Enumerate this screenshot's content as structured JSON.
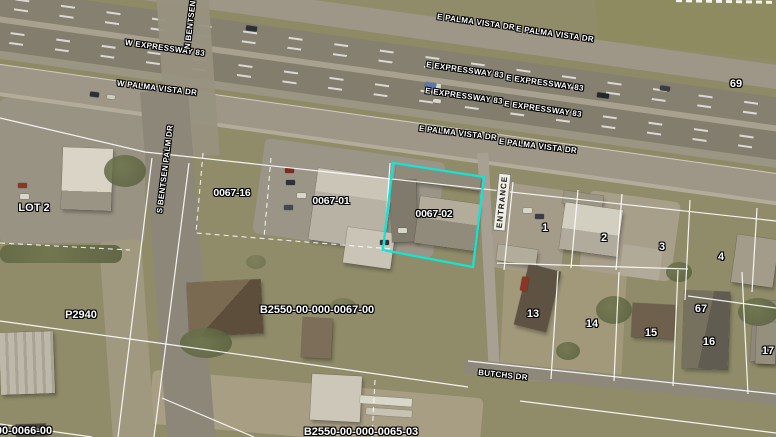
{
  "app": {
    "type": "aerial-parcel-map-viewer"
  },
  "highway_labels": {
    "w_expressway": "W EXPRESSWAY 83",
    "e_expressway": "E EXPRESSWAY 83",
    "w_palma_vista": "W PALMA VISTA DR",
    "e_palma_vista": "E PALMA VISTA DR"
  },
  "street_labels": {
    "n_bentsen_clipped": "N BENTSEN PA",
    "s_bentsen": "S BENTSEN PALM DR",
    "butchs": "BUTCHS DR",
    "entrance": "ENTRANCE"
  },
  "parcel_labels": {
    "lot2": "LOT 2",
    "p2940": "P2940",
    "parcel_0067_16": "0067-16",
    "parcel_0067_01": "0067-01",
    "parcel_0067_02": "0067-02",
    "account_0067": "B2550-00-000-0067-00",
    "account_0065": "B2550-00-000-0065-03",
    "account_0066_clipped": "00-0066-00"
  },
  "lot_numbers": [
    "1",
    "2",
    "3",
    "4",
    "13",
    "14",
    "15",
    "16",
    "17",
    "67",
    "69"
  ],
  "selection": {
    "selected_parcel": "0067-02",
    "highlight_color": "#17E2D3"
  },
  "label_style": {
    "text_color": "#FFFFFF",
    "outline_color": "#000000"
  }
}
